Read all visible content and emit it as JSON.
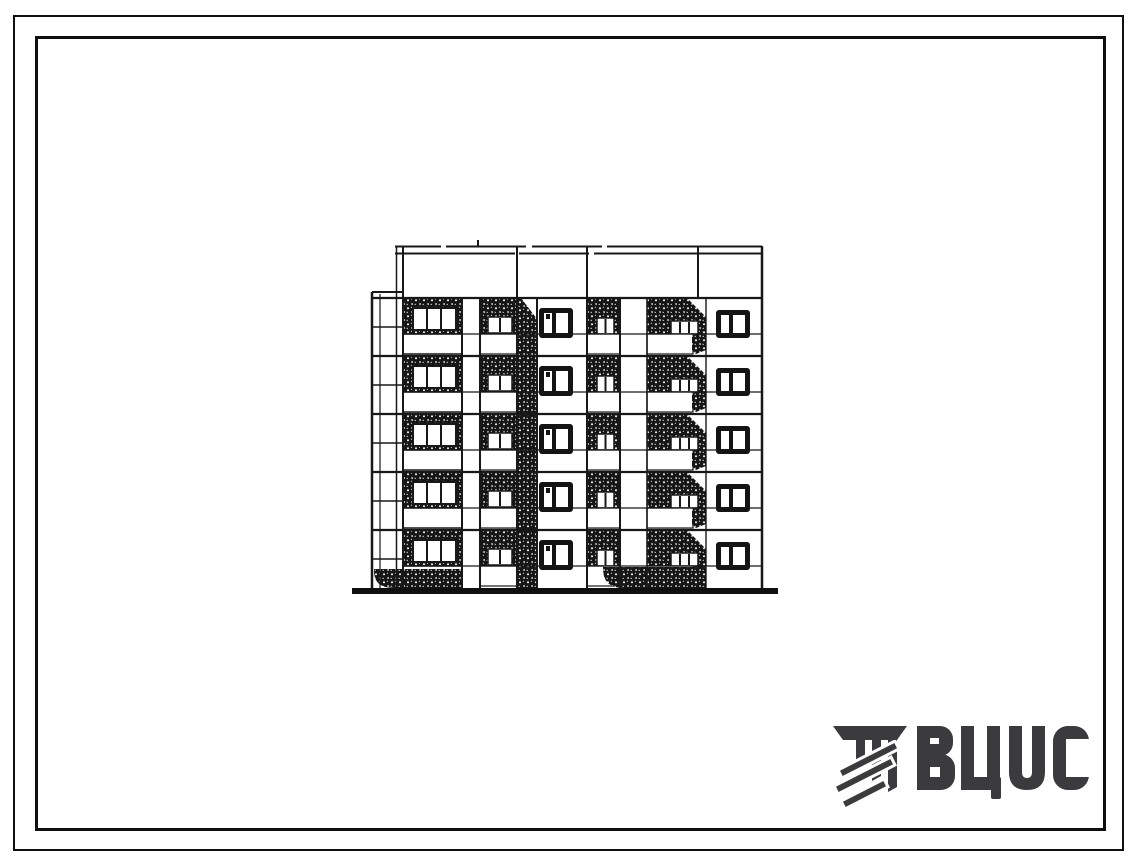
{
  "page": {
    "kind": "scanned standard-design catalogue sheet",
    "background": "#ffffff",
    "frame_color": "#0f0f0f"
  },
  "drawing": {
    "title": "five-storey block-section elevation",
    "storeys": 5,
    "ink_color": "#161616"
  },
  "logo": {
    "text": "ВЦИС",
    "color": "#3b3b3d"
  }
}
